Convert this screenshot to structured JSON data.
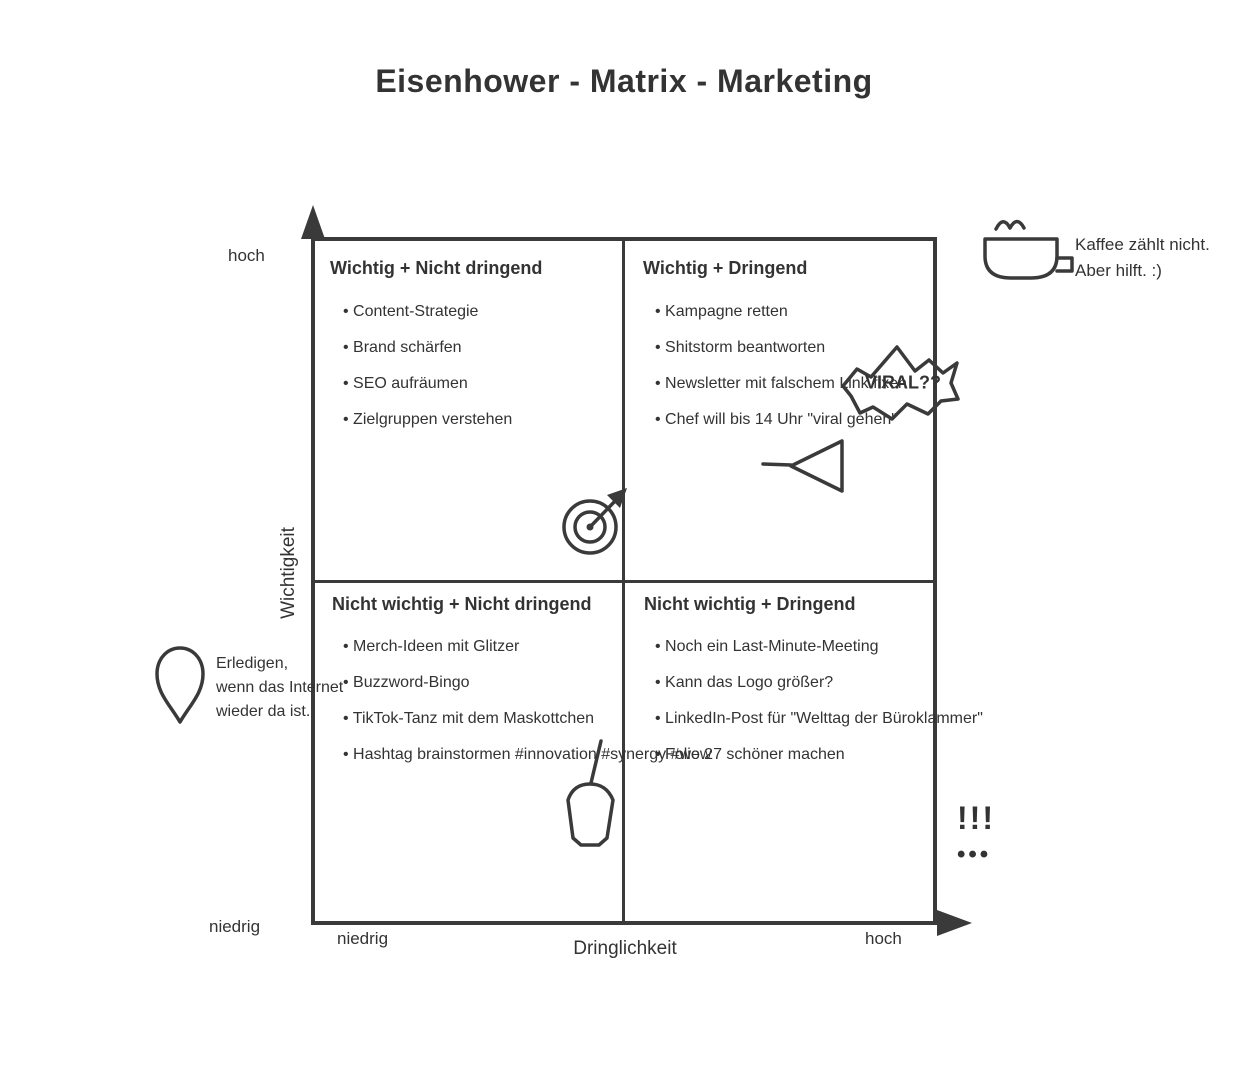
{
  "title": "Eisenhower - Matrix - Marketing",
  "axes": {
    "y_label": "Wichtigkeit",
    "y_high": "hoch",
    "y_low": "niedrig",
    "x_label": "Dringlichkeit",
    "x_low": "niedrig",
    "x_high": "hoch"
  },
  "quadrants": [
    {
      "heading": "Wichtig + Nicht dringend",
      "items": [
        "Content-Strategie",
        "Brand schärfen",
        "SEO aufräumen",
        "Zielgruppen verstehen"
      ]
    },
    {
      "heading": "Wichtig + Dringend",
      "items": [
        "Kampagne retten",
        "Shitstorm beantworten",
        "Newsletter mit falschem Link fixen",
        "Chef will bis 14 Uhr \"viral gehen\""
      ]
    },
    {
      "heading": "Nicht wichtig + Nicht dringend",
      "items": [
        "Merch-Ideen mit Glitzer",
        "Buzzword-Bingo",
        "TikTok-Tanz mit dem Maskottchen",
        "Hashtag brainstormen #innovation #synergy #wow"
      ]
    },
    {
      "heading": "Nicht wichtig + Dringend",
      "items": [
        "Noch ein Last-Minute-Meeting",
        "Kann das Logo größer?",
        "LinkedIn-Post für \"Welttag der Büroklammer\"",
        "Folie 27 schöner machen"
      ]
    }
  ],
  "annotations": {
    "coffee": {
      "line1": "Kaffee zählt nicht.",
      "line2": "Aber hilft. :)"
    },
    "viral": "VIRAL??",
    "internet": {
      "line1": "Erledigen,",
      "line2": "wenn das Internet",
      "line3": "wieder da ist."
    },
    "exclamation": "!!!",
    "dots": "•••"
  },
  "icons": [
    "coffee-cup-icon",
    "starburst-icon",
    "paper-plane-icon",
    "target-arrow-icon",
    "balloon-icon",
    "teardrop-icon"
  ],
  "colors": {
    "ink": "#333333",
    "line": "#3a3a3a",
    "background": "#ffffff"
  }
}
